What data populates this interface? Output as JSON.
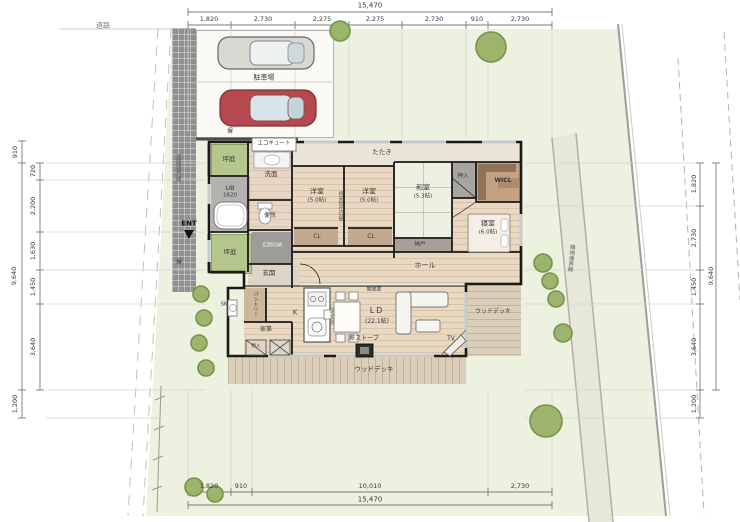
{
  "site": {
    "road": "道路",
    "road_boundary": "道路境界線",
    "neighbor_boundary": "隣地境界線",
    "parking": "駐車場",
    "fence_top": "塀",
    "fence_left": "塀",
    "entrance_marker": "ENT"
  },
  "dims": {
    "top_total": "15,470",
    "top_segments": [
      "1,820",
      "2,730",
      "2,275",
      "2,275",
      "2,730",
      "910",
      "2,730"
    ],
    "bottom_segments": [
      "1,820",
      "910",
      "10,010",
      "2,730"
    ],
    "bottom_total": "15,470",
    "left_outer": [
      "910",
      "9,640",
      "1,200"
    ],
    "left_segments": [
      "720",
      "2,200",
      "1,630",
      "1,450",
      "3,640"
    ],
    "right_segments": [
      "1,820",
      "2,730",
      "1,450",
      "3,640",
      "1,200"
    ],
    "right_total": "9,640"
  },
  "rooms": {
    "tataki": "たたき",
    "western1": {
      "name": "洋室",
      "size": "(5.0帖)"
    },
    "western2": {
      "name": "洋室",
      "size": "(5.0帖)"
    },
    "partition_note": "将来間仕切壁",
    "japanese": {
      "name": "和室",
      "size": "(5.3帖)"
    },
    "oshiire": "押入",
    "wicl": "WICL",
    "bedroom": {
      "name": "寝室",
      "size": "(6.0帖)"
    },
    "nando": "納戸",
    "cl1": "CL",
    "cl2": "CL",
    "hall": "ホール",
    "opening_note": "開放扉",
    "ld": {
      "name": "LD",
      "size": "(22.1帖)"
    },
    "kitchen": "K",
    "kitchen_counter_note": "W2550",
    "pantry": "パントリー",
    "sk": "SK",
    "utility": "家事",
    "storage_small": "物入",
    "wood_stove": "薪ストーブ",
    "tv": "TV",
    "wood_deck_bottom": "ウッドデッキ",
    "wood_deck_right": "ウッドデッキ",
    "entrance_hall": "玄関",
    "entrance_storage": "玄関収納",
    "courtyard1": "坪庭",
    "courtyard2": "坪庭",
    "unit_bath": {
      "name": "UB",
      "size": "1620"
    },
    "washroom": "洗面",
    "toilet": "便所",
    "ecocute": "エコキュート"
  },
  "colors": {
    "site_green": "#edf1df",
    "courtyard_green": "#b5c78d",
    "wood_floor": "#e9d8c2",
    "deck": "#dccfba",
    "red_car": "#b5494f",
    "gray_car": "#d9d9d3",
    "tree": "#9cb46b",
    "wall": "#1a1a1a"
  }
}
